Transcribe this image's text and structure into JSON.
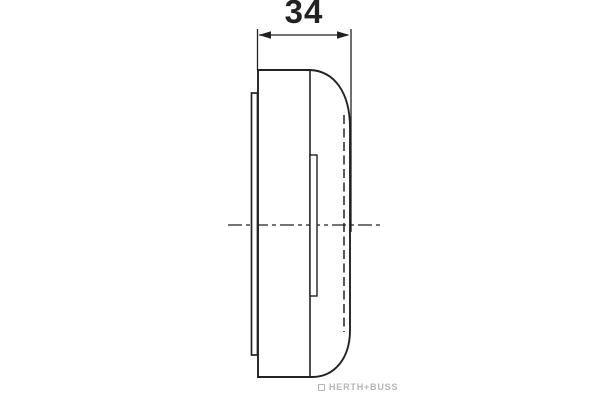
{
  "drawing": {
    "dimension_label": "34",
    "watermark_brand": "HERTH+BUSS",
    "icons": {
      "watermark_logo": "herth-buss-logo"
    },
    "colors": {
      "line": "#222222",
      "background": "#ffffff",
      "watermark": "#b5b5b5"
    }
  }
}
